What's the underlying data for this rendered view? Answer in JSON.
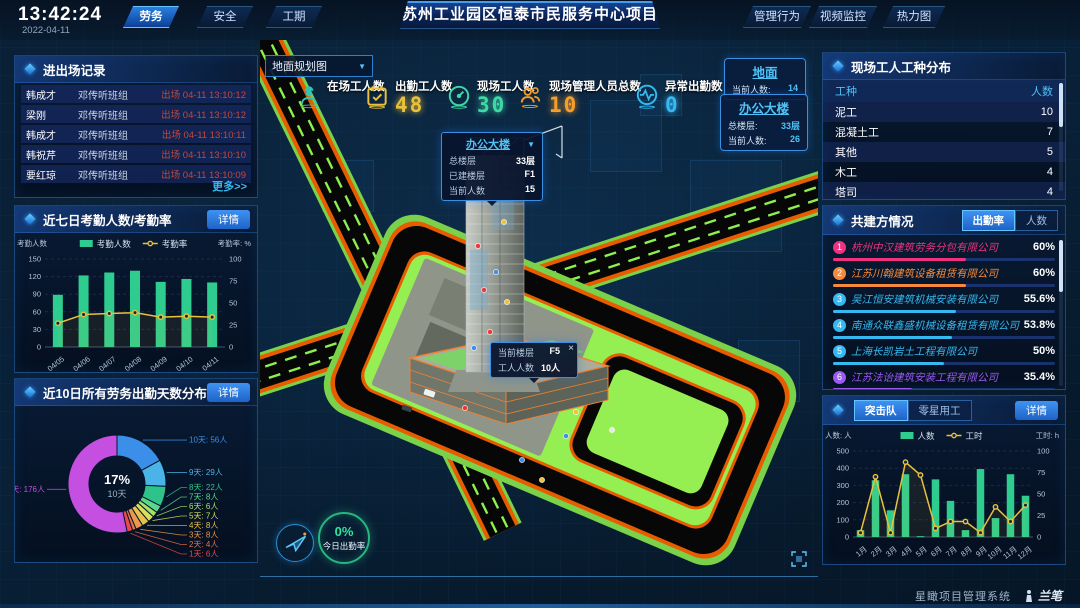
{
  "header": {
    "time": "13:42:24",
    "date": "2022-04-11",
    "left_tabs": [
      {
        "label": "劳务",
        "active": true
      },
      {
        "label": "安全",
        "active": false
      },
      {
        "label": "工期",
        "active": false
      }
    ],
    "title": "苏州工业园区恒泰市民服务中心项目",
    "right_tabs": [
      {
        "label": "管理行为"
      },
      {
        "label": "视频监控"
      },
      {
        "label": "热力图"
      }
    ]
  },
  "entry_exit": {
    "title": "进出场记录",
    "more_label": "更多>>",
    "rows": [
      {
        "name": "韩成才",
        "team": "邓传听班组",
        "event": "出场 04-11 13:10:12"
      },
      {
        "name": "梁刚",
        "team": "邓传听班组",
        "event": "出场 04-11 13:10:12"
      },
      {
        "name": "韩成才",
        "team": "邓传听班组",
        "event": "出场 04-11 13:10:11"
      },
      {
        "name": "韩祝芹",
        "team": "邓传听班组",
        "event": "出场 04-11 13:10:10"
      },
      {
        "name": "要红琼",
        "team": "邓传听班组",
        "event": "出场 04-11 13:10:09"
      }
    ]
  },
  "attendance": {
    "title": "近七日考勤人数/考勤率",
    "detail_label": "详情",
    "chart": {
      "type": "bar+line",
      "categories": [
        "04/05",
        "04/06",
        "04/07",
        "04/08",
        "04/09",
        "04/10",
        "04/11"
      ],
      "bar_series": {
        "name": "考勤人数",
        "color": "#2fcc8f",
        "values": [
          89,
          122,
          127,
          130,
          111,
          116,
          110
        ]
      },
      "line_series": {
        "name": "考勤率",
        "color": "#e9c13b",
        "values": [
          27,
          37,
          38,
          39,
          34,
          35,
          34
        ]
      },
      "left_axis": {
        "label": "考勤人数",
        "min": 0,
        "max": 150,
        "step": 30
      },
      "right_axis": {
        "label": "考勤率: %",
        "min": 0,
        "max": 100,
        "step": 25
      }
    }
  },
  "distribution": {
    "title": "近10日所有劳务出勤天数分布",
    "detail_label": "详情",
    "chart": {
      "type": "donut",
      "unit": "人",
      "center": {
        "pct": "17%",
        "label": "10天"
      },
      "items": [
        {
          "label": "10天",
          "count": 56,
          "color": "#3b8fe8"
        },
        {
          "label": "9天",
          "count": 29,
          "color": "#4ab4e8"
        },
        {
          "label": "8天",
          "count": 22,
          "color": "#2ec489"
        },
        {
          "label": "7天",
          "count": 8,
          "color": "#5ad98c"
        },
        {
          "label": "6天",
          "count": 6,
          "color": "#a8e063"
        },
        {
          "label": "5天",
          "count": 7,
          "color": "#d6e05a"
        },
        {
          "label": "4天",
          "count": 8,
          "color": "#e9c04a"
        },
        {
          "label": "3天",
          "count": 8,
          "color": "#e9994a"
        },
        {
          "label": "2天",
          "count": 4,
          "color": "#e9714a"
        },
        {
          "label": "1天",
          "count": 6,
          "color": "#e94a4a"
        },
        {
          "label": "0天",
          "count": 176,
          "color": "#c44fe0"
        }
      ]
    }
  },
  "scene": {
    "view_label": "地面规划图",
    "view_caret": "▼",
    "stats": [
      {
        "label": "在场工人数",
        "value": "",
        "color": "#2ec4b6"
      },
      {
        "label": "出勤工人数",
        "value": "48",
        "color": "#e9c13b"
      },
      {
        "label": "现场工人数",
        "value": "30",
        "color": "#3fd9a6"
      },
      {
        "label": "现场管理人员总数",
        "value": "10",
        "color": "#f59e2a"
      },
      {
        "label": "异常出勤数",
        "value": "0",
        "color": "#35b9f0"
      }
    ],
    "info_boxes": [
      {
        "title": "地面",
        "rows": [
          {
            "label": "当前人数:",
            "value": "14"
          }
        ]
      },
      {
        "title": "办公大楼",
        "rows": [
          {
            "label": "总楼层:",
            "value": "33层"
          },
          {
            "label": "当前人数:",
            "value": "26"
          }
        ]
      }
    ],
    "building_popup": {
      "title": "办公大楼",
      "caret": "▼",
      "rows": [
        {
          "label": "总楼层",
          "value": "33层"
        },
        {
          "label": "已建楼层",
          "value": "F1"
        },
        {
          "label": "当前人数",
          "value": "15"
        }
      ]
    },
    "floor_popup": {
      "close": "×",
      "rows": [
        {
          "label": "当前楼层",
          "value": "F5"
        },
        {
          "label": "工人人数",
          "value": "10人"
        }
      ]
    },
    "attendance_ring": {
      "value": "0%",
      "label": "今日出勤率"
    }
  },
  "worker_types": {
    "title": "现场工人工种分布",
    "columns": [
      "工种",
      "人数"
    ],
    "rows": [
      {
        "type": "泥工",
        "count": "10"
      },
      {
        "type": "混凝土工",
        "count": "7"
      },
      {
        "type": "其他",
        "count": "5"
      },
      {
        "type": "木工",
        "count": "4"
      },
      {
        "type": "塔司",
        "count": "4"
      }
    ]
  },
  "partners": {
    "title": "共建方情况",
    "tabs": [
      {
        "label": "出勤率",
        "active": true
      },
      {
        "label": "人数",
        "active": false
      }
    ],
    "rows": [
      {
        "rank": "1",
        "name": "杭州中汉建筑劳务分包有限公司",
        "value": "60%",
        "pct": 60,
        "color": "#f0327e"
      },
      {
        "rank": "2",
        "name": "江苏川翰建筑设备租赁有限公司",
        "value": "60%",
        "pct": 60,
        "color": "#f58a3d"
      },
      {
        "rank": "3",
        "name": "吴江恒安建筑机械安装有限公司",
        "value": "55.6%",
        "pct": 55.6,
        "color": "#35b9f0"
      },
      {
        "rank": "4",
        "name": "南通众联鑫盛机械设备租赁有限公司",
        "value": "53.8%",
        "pct": 53.8,
        "color": "#35b9f0"
      },
      {
        "rank": "5",
        "name": "上海长凯岩土工程有限公司",
        "value": "50%",
        "pct": 50,
        "color": "#35b9f0"
      },
      {
        "rank": "6",
        "name": "江苏法诒建筑安装工程有限公司",
        "value": "35.4%",
        "pct": 35.4,
        "color": "#9b59f0"
      }
    ]
  },
  "squad": {
    "tabs": [
      {
        "label": "突击队",
        "active": true
      },
      {
        "label": "零星用工",
        "active": false
      }
    ],
    "detail_label": "详情",
    "chart": {
      "type": "bar+line",
      "categories": [
        "1月",
        "2月",
        "3月",
        "4月",
        "5月",
        "6月",
        "7月",
        "8月",
        "9月",
        "10月",
        "11月",
        "12月"
      ],
      "bar_series": {
        "name": "人数",
        "color": "#2fcc8f",
        "values": [
          40,
          330,
          155,
          365,
          5,
          335,
          210,
          40,
          395,
          110,
          365,
          240
        ]
      },
      "line_series": {
        "name": "工时",
        "color": "#e9c13b",
        "values": [
          5,
          70,
          5,
          87,
          72,
          10,
          18,
          18,
          5,
          35,
          18,
          37
        ]
      },
      "left_axis": {
        "label": "人数: 人",
        "min": 0,
        "max": 500,
        "step": 100
      },
      "right_axis": {
        "label": "工时: h",
        "min": 0,
        "max": 100,
        "step": 25
      }
    }
  },
  "footer": {
    "brand": "星瞰项目管理系统",
    "logo": "兰笔"
  }
}
